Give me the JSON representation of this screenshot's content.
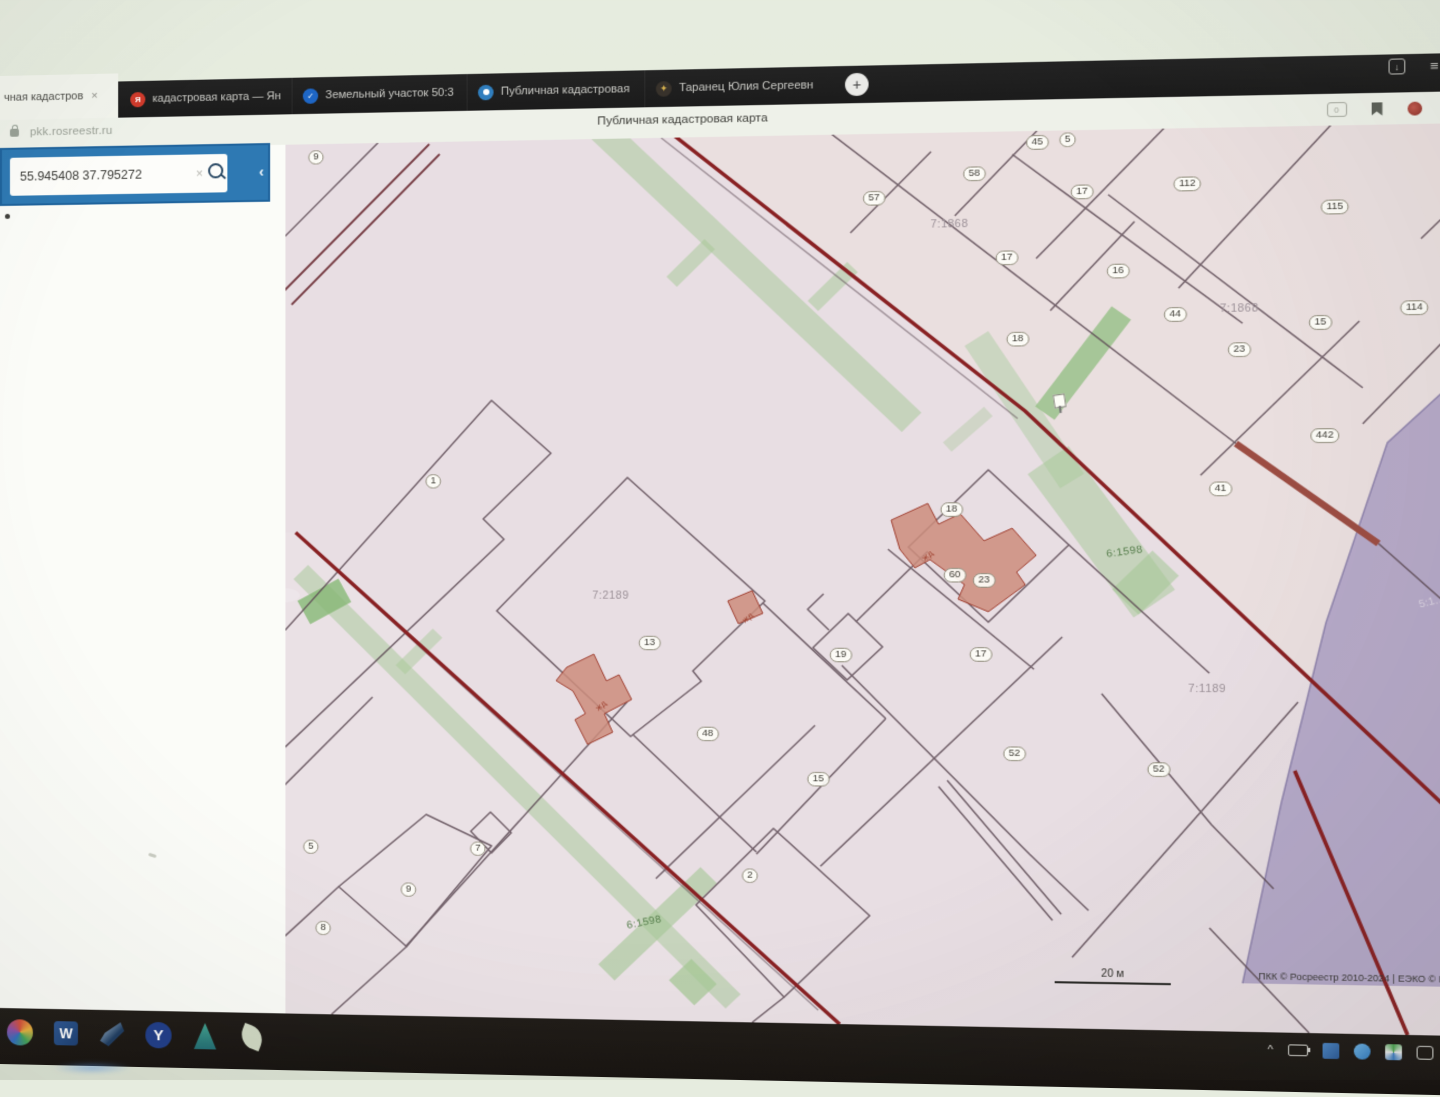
{
  "browser": {
    "active_tab": {
      "label": "чная кадастров",
      "close": "×"
    },
    "tabs": [
      {
        "label": "кадастровая карта — Ян",
        "icon": "yandex-icon",
        "glyph": "Я"
      },
      {
        "label": "Земельный участок 50:3",
        "icon": "check-icon",
        "glyph": "✓"
      },
      {
        "label": "Публичная кадастровая",
        "icon": "pkk-icon",
        "glyph": ""
      },
      {
        "label": "Таранец Юлия Сергеевн",
        "icon": "eagle-icon",
        "glyph": "✦"
      }
    ],
    "new_tab": "+",
    "window_controls": {
      "menu": "≡",
      "minimize": "–",
      "maximize": "□",
      "close": "×",
      "download": "↓"
    },
    "url": "pkk.rosreestr.ru",
    "page_title": "Публичная кадастровая карта"
  },
  "sidebar": {
    "search_value": "55.945408 37.795272",
    "clear": "×",
    "collapse": "‹"
  },
  "map": {
    "scale_label": "20 м",
    "attribution": "ПКК © Росреестр 2010-2024 | ЕЭКО © Росреестр 2019-20",
    "control_icons": [
      "location-marker-icon",
      "measure-icon",
      "compass-icon"
    ],
    "labels": [
      {
        "x": 30,
        "y": 13,
        "t": "9",
        "k": "badge"
      },
      {
        "x": 562,
        "y": 62,
        "t": "57",
        "k": "badge"
      },
      {
        "x": 655,
        "y": 40,
        "t": "58",
        "k": "badge"
      },
      {
        "x": 713,
        "y": 11,
        "t": "45",
        "k": "badge"
      },
      {
        "x": 741,
        "y": 9,
        "t": "5",
        "k": "badge"
      },
      {
        "x": 754,
        "y": 59,
        "t": "17",
        "k": "badge"
      },
      {
        "x": 850,
        "y": 53,
        "t": "112",
        "k": "badge"
      },
      {
        "x": 1113,
        "y": 49,
        "t": "16",
        "k": "badge"
      },
      {
        "x": 983,
        "y": 77,
        "t": "115",
        "k": "badge"
      },
      {
        "x": 685,
        "y": 121,
        "t": "17",
        "k": "badge"
      },
      {
        "x": 787,
        "y": 135,
        "t": "16",
        "k": "badge"
      },
      {
        "x": 839,
        "y": 177,
        "t": "44",
        "k": "badge"
      },
      {
        "x": 897,
        "y": 211,
        "t": "23",
        "k": "badge"
      },
      {
        "x": 970,
        "y": 186,
        "t": "15",
        "k": "badge"
      },
      {
        "x": 1054,
        "y": 173,
        "t": "114",
        "k": "badge"
      },
      {
        "x": 695,
        "y": 199,
        "t": "18",
        "k": "badge"
      },
      {
        "x": 974,
        "y": 293,
        "t": "442",
        "k": "badge"
      },
      {
        "x": 880,
        "y": 343,
        "t": "41",
        "k": "badge"
      },
      {
        "x": 144,
        "y": 333,
        "t": "1",
        "k": "badge"
      },
      {
        "x": 634,
        "y": 362,
        "t": "18",
        "k": "badge"
      },
      {
        "x": 637,
        "y": 425,
        "t": "60",
        "k": "badge"
      },
      {
        "x": 664,
        "y": 430,
        "t": "23",
        "k": "badge"
      },
      {
        "x": 351,
        "y": 491,
        "t": "13",
        "k": "badge"
      },
      {
        "x": 531,
        "y": 502,
        "t": "19",
        "k": "badge"
      },
      {
        "x": 661,
        "y": 501,
        "t": "17",
        "k": "badge"
      },
      {
        "x": 406,
        "y": 579,
        "t": "48",
        "k": "badge"
      },
      {
        "x": 510,
        "y": 622,
        "t": "15",
        "k": "badge"
      },
      {
        "x": 692,
        "y": 596,
        "t": "52",
        "k": "badge"
      },
      {
        "x": 824,
        "y": 610,
        "t": "52",
        "k": "badge"
      },
      {
        "x": 25,
        "y": 693,
        "t": "5",
        "k": "badge"
      },
      {
        "x": 187,
        "y": 693,
        "t": "7",
        "k": "badge"
      },
      {
        "x": 120,
        "y": 734,
        "t": "9",
        "k": "badge"
      },
      {
        "x": 37,
        "y": 773,
        "t": "8",
        "k": "badge"
      },
      {
        "x": 446,
        "y": 716,
        "t": "2",
        "k": "badge"
      },
      {
        "x": 632,
        "y": 88,
        "t": "7:1868",
        "k": "quarter"
      },
      {
        "x": 897,
        "y": 172,
        "t": "7:1868",
        "k": "quarter"
      },
      {
        "x": 314,
        "y": 445,
        "t": "7:2189",
        "k": "quarter"
      },
      {
        "x": 868,
        "y": 533,
        "t": "7:1189",
        "k": "quarter"
      },
      {
        "x": 793,
        "y": 403,
        "t": "6:1598",
        "k": "green",
        "r": -8
      },
      {
        "x": 346,
        "y": 763,
        "t": "6:1598",
        "k": "green",
        "r": -12
      },
      {
        "x": 612,
        "y": 406,
        "t": "жд",
        "k": "bldg",
        "r": -42
      },
      {
        "x": 444,
        "y": 466,
        "t": "жд",
        "k": "bldg",
        "r": -42
      },
      {
        "x": 305,
        "y": 552,
        "t": "жд",
        "k": "bldg",
        "r": -42
      },
      {
        "x": 1070,
        "y": 450,
        "t": "5:1…",
        "k": "purple",
        "r": -15
      }
    ]
  },
  "taskbar": {
    "left_icons": [
      "color-wheel-icon",
      "word-icon",
      "swoosh-icon",
      "yandex-browser-icon",
      "teal-app-icon",
      "leaf-icon"
    ],
    "tray_icons": [
      "chevron-up-icon",
      "battery-icon",
      "blue-square-icon",
      "blue-round-icon",
      "pinwheel-icon",
      "window-icon",
      "phone-icon",
      "red-square-icon"
    ],
    "language": "ENG"
  }
}
